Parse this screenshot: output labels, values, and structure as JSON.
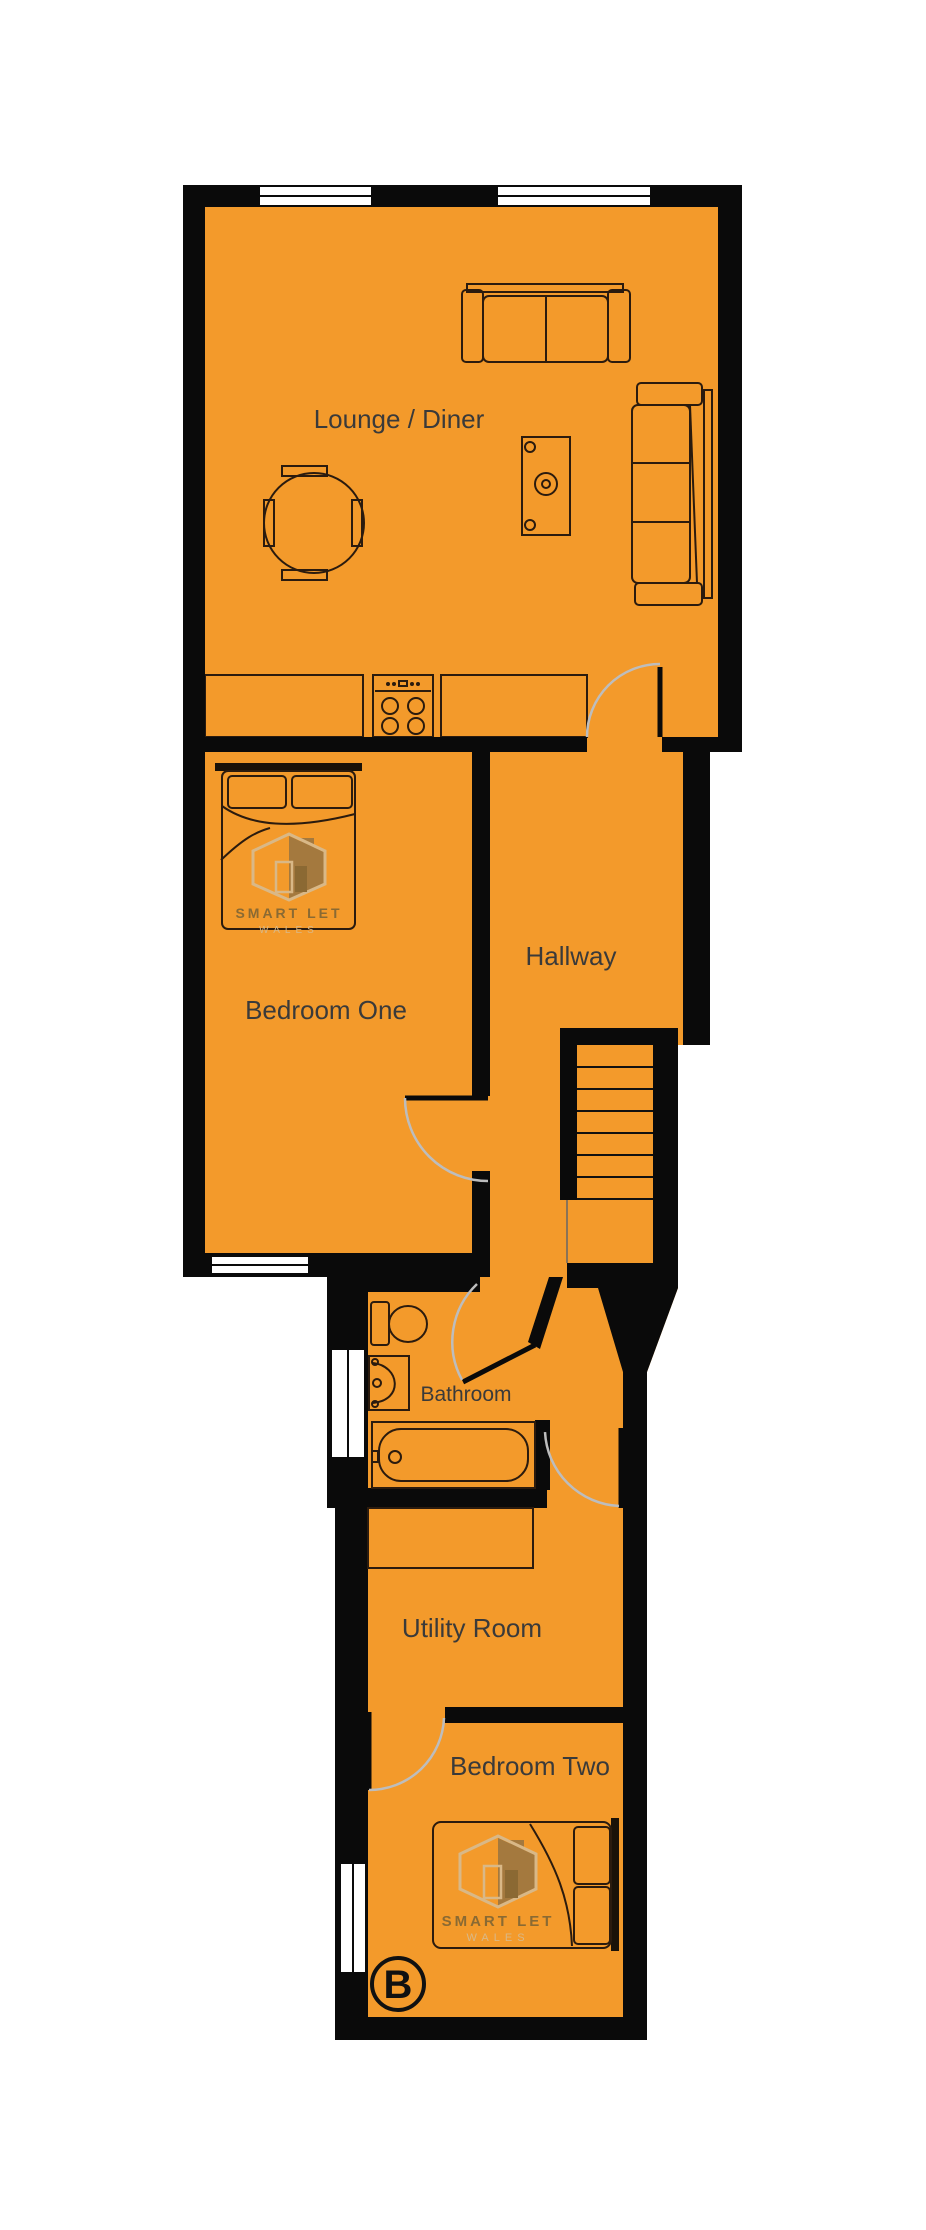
{
  "rooms": [
    {
      "id": "lounge-diner",
      "label": "Lounge / Diner"
    },
    {
      "id": "bedroom-one",
      "label": "Bedroom One"
    },
    {
      "id": "hallway",
      "label": "Hallway"
    },
    {
      "id": "bathroom",
      "label": "Bathroom"
    },
    {
      "id": "utility-room",
      "label": "Utility Room"
    },
    {
      "id": "bedroom-two",
      "label": "Bedroom Two"
    }
  ],
  "floor_marker": "B",
  "watermark": {
    "line1": "SMART LET",
    "line2": "WALES"
  },
  "colors": {
    "floor": "#F39A2B",
    "wall": "#0A0A0A",
    "furniture_line": "#2B1B0E",
    "door_arc": "#BDBDBD",
    "label_text": "#3A3A3A",
    "logo_beige": "#D9B887",
    "logo_brown": "#A4793E",
    "logo_text": "#8A6A33"
  }
}
